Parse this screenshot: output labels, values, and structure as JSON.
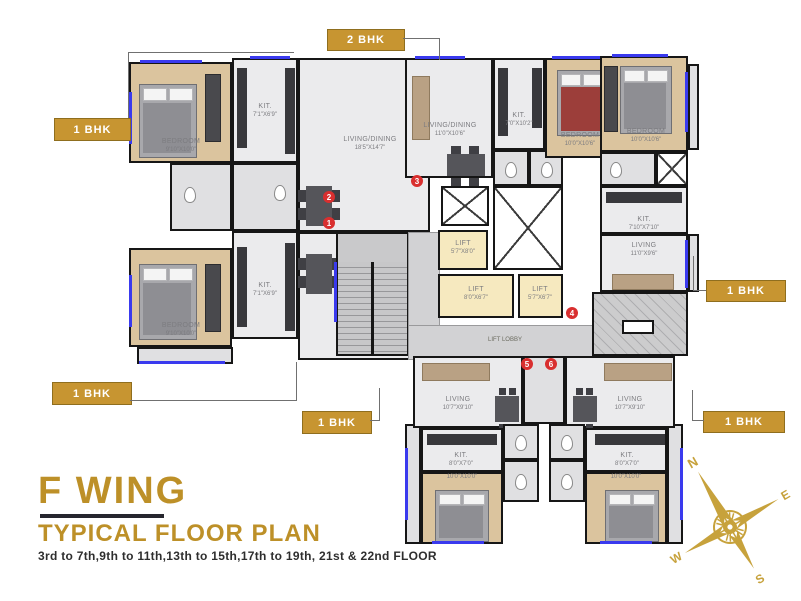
{
  "title_block": {
    "wing": "F WING",
    "plan_type": "TYPICAL FLOOR PLAN",
    "floors": "3rd to 7th,9th to 11th,13th to 15th,17th to 19th, 21st & 22nd FLOOR"
  },
  "unit_labels": [
    {
      "text": "2 BHK"
    },
    {
      "text": "1 BHK"
    },
    {
      "text": "1 BHK"
    },
    {
      "text": "1 BHK"
    },
    {
      "text": "1 BHK"
    },
    {
      "text": "1 BHK"
    }
  ],
  "flats": [
    "1",
    "2",
    "3",
    "4",
    "5",
    "6"
  ],
  "rooms": {
    "tl_bedroom": {
      "name": "BEDROOM",
      "dim": "9'10\"X10'0\""
    },
    "tl_kitchen": {
      "name": "KIT.",
      "dim": "7'1\"X6'9\""
    },
    "tl_living": {
      "name": "LIVING/DINING",
      "dim": "18'5\"X14'7\""
    },
    "bl_bedroom": {
      "name": "BEDROOM",
      "dim": "9'10\"X10'0\""
    },
    "bl_kitchen": {
      "name": "KIT.",
      "dim": "7'1\"X6'9\""
    },
    "bl_living": {
      "name": "LIVING/DINING",
      "dim": "18'5\"X14'7\""
    },
    "m_living": {
      "name": "LIVING/DINING",
      "dim": "11'0\"X10'6\""
    },
    "m_kitchen": {
      "name": "KIT.",
      "dim": "7'0\"X10'2\""
    },
    "m_bedroom": {
      "name": "BEDROOM",
      "dim": "10'0\"X10'6\""
    },
    "tr_bedroom": {
      "name": "BEDROOM",
      "dim": "10'0\"X10'6\""
    },
    "tr_kitchen": {
      "name": "KIT.",
      "dim": "7'10\"X7'10\""
    },
    "tr_living": {
      "name": "LIVING",
      "dim": "11'0\"X9'6\""
    },
    "b5_living": {
      "name": "LIVING",
      "dim": "10'7\"X9'10\""
    },
    "b5_kitchen": {
      "name": "KIT.",
      "dim": "8'0\"X7'0\""
    },
    "b5_bedroom": {
      "name": "BEDROOM",
      "dim": "10'0\"X10'0\""
    },
    "b6_living": {
      "name": "LIVING",
      "dim": "10'7\"X9'10\""
    },
    "b6_kitchen": {
      "name": "KIT.",
      "dim": "8'0\"X7'0\""
    },
    "b6_bedroom": {
      "name": "BEDROOM",
      "dim": "10'0\"X10'0\""
    }
  },
  "core": {
    "lift": "LIFT",
    "lift1_dim": "5'7\"X8'0\"",
    "lift2_dim": "8'0\"X6'7\"",
    "lift3_dim": "5'7\"X6'7\"",
    "lobby": "LIFT LOBBY"
  },
  "compass": {
    "n": "N",
    "e": "E",
    "s": "S",
    "w": "W"
  },
  "colors": {
    "accent_gold": "#C79531",
    "title_gold": "#BD9028",
    "flat_red": "#D92F2F",
    "window_blue": "#3A3AEE",
    "wall": "#161616",
    "wood_floor": "#DBC49E",
    "lift_yellow": "#F6E9BF"
  }
}
